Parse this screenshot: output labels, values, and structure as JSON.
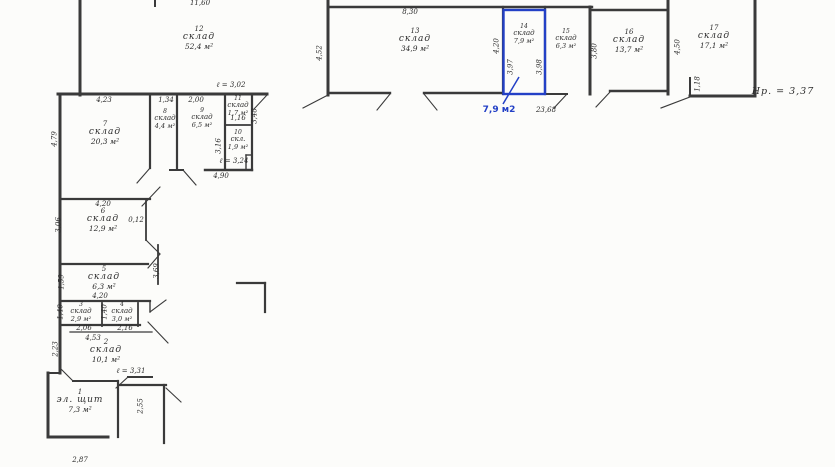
{
  "colors": {
    "highlight": "#2340c6",
    "ink": "#3a3a3a",
    "paper": "#fcfcfa"
  },
  "highlight": {
    "room_number": "14",
    "label": "7,9 м2"
  },
  "annotations": {
    "height_mark": "Нр. = 3,37"
  },
  "rooms": [
    {
      "number": "1",
      "name": "эл. щит",
      "area": "7,3 м²"
    },
    {
      "number": "2",
      "name": "склад",
      "area": "10,1 м²"
    },
    {
      "number": "3",
      "name": "склад",
      "area": "2,9 м²"
    },
    {
      "number": "4",
      "name": "склад",
      "area": "3,0 м²"
    },
    {
      "number": "5",
      "name": "склад",
      "area": "6,3 м²"
    },
    {
      "number": "6",
      "name": "склад",
      "area": "12,9 м²"
    },
    {
      "number": "7",
      "name": "склад",
      "area": "20,3 м²"
    },
    {
      "number": "8",
      "name": "склад",
      "area": "4,4 м²"
    },
    {
      "number": "9",
      "name": "склад",
      "area": "6,5 м²"
    },
    {
      "number": "10",
      "name": "скл.",
      "area": "1,9 м²"
    },
    {
      "number": "11",
      "name": "склад",
      "area": "1,7 м²"
    },
    {
      "number": "12",
      "name": "склад",
      "area": "52,4 м²"
    },
    {
      "number": "13",
      "name": "склад",
      "area": "34,9 м²"
    },
    {
      "number": "14",
      "name": "склад",
      "area": "7,9 м²"
    },
    {
      "number": "15",
      "name": "склад",
      "area": "6,3 м²"
    },
    {
      "number": "16",
      "name": "склад",
      "area": "13,7 м²"
    },
    {
      "number": "17",
      "name": "склад",
      "area": "17,1 м²"
    }
  ],
  "dims": [
    "11,60",
    "8,30",
    "ℓ = 3,02",
    "4,23",
    "1,34",
    "2,00",
    "1,16",
    "ℓ = 3,24",
    "4,90",
    "23,68",
    "Нр. = 3,37",
    "4,20",
    "0,12",
    "4,20",
    "2,06",
    "2,16",
    "4,53",
    "ℓ = 3,31",
    "2,87",
    "4,52",
    "4,20",
    "3,97",
    "3,98",
    "3,80",
    "4,50",
    "1,18",
    "4,79",
    "3,48",
    "3,16",
    "3,06",
    "1,59",
    "1,40",
    "1,40",
    "3,69",
    "2,23",
    "2,55"
  ]
}
